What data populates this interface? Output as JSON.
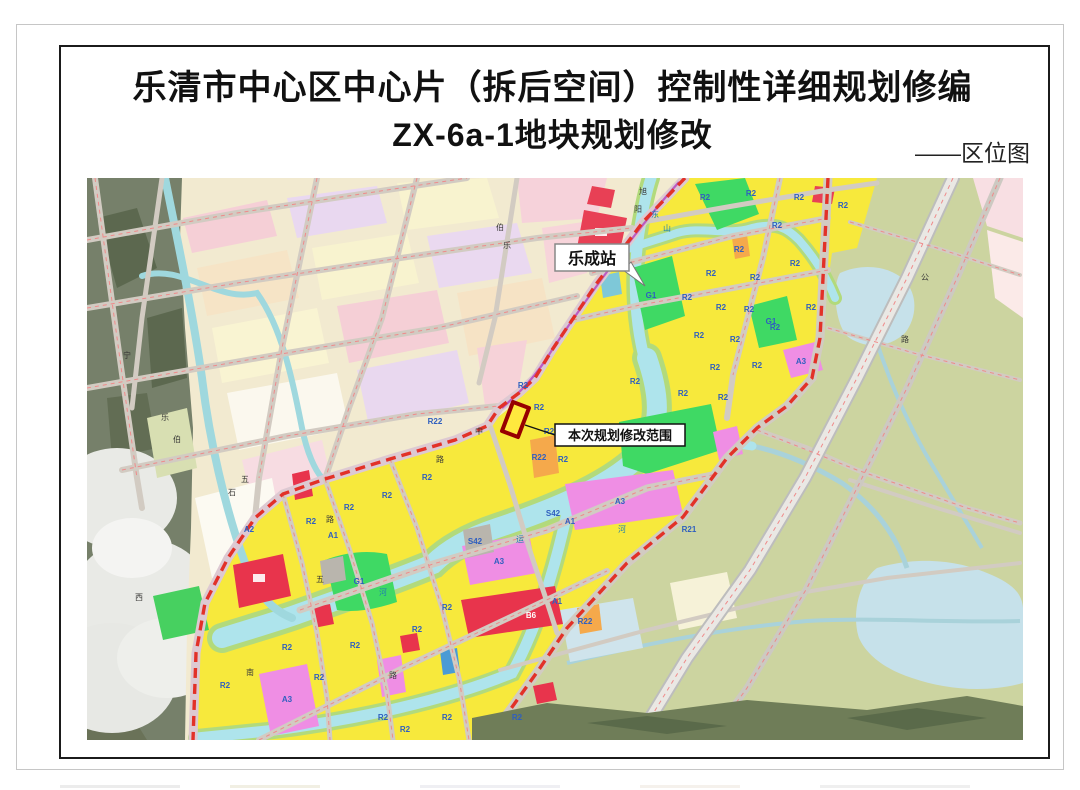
{
  "page": {
    "title_line1": "乐清市中心区中心片（拆后空间）控制性详细规划修编",
    "title_line2": "ZX-6a-1地块规划修改",
    "corner_label": "——区位图"
  },
  "map": {
    "callouts": {
      "station": "乐成站",
      "scope": "本次规划修改范围"
    },
    "colors": {
      "residential_yellow": "#f7e93c",
      "green_space": "#3fd964",
      "public_magenta": "#ef8ee4",
      "commercial_red": "#e8344c",
      "orange": "#f5a94b",
      "water_cyan": "#aee4ec",
      "rural_olive": "#ccd4a0",
      "boundary_red": "#e23128",
      "rail_purple": "#b84fc0",
      "old_plan_pink": "#f5cfd6"
    },
    "labels": [
      {
        "t": "R2",
        "x": 618,
        "y": 22,
        "c": "blue"
      },
      {
        "t": "R2",
        "x": 664,
        "y": 18,
        "c": "blue"
      },
      {
        "t": "R2",
        "x": 712,
        "y": 22,
        "c": "blue"
      },
      {
        "t": "R2",
        "x": 756,
        "y": 30,
        "c": "blue"
      },
      {
        "t": "R2",
        "x": 690,
        "y": 50,
        "c": "blue"
      },
      {
        "t": "R2",
        "x": 652,
        "y": 74,
        "c": "blue"
      },
      {
        "t": "R2",
        "x": 624,
        "y": 98,
        "c": "blue"
      },
      {
        "t": "R2",
        "x": 668,
        "y": 102,
        "c": "blue"
      },
      {
        "t": "R2",
        "x": 708,
        "y": 88,
        "c": "blue"
      },
      {
        "t": "R2",
        "x": 600,
        "y": 122,
        "c": "blue"
      },
      {
        "t": "R2",
        "x": 634,
        "y": 132,
        "c": "blue"
      },
      {
        "t": "R2",
        "x": 662,
        "y": 134,
        "c": "blue"
      },
      {
        "t": "R2",
        "x": 612,
        "y": 160,
        "c": "blue"
      },
      {
        "t": "R2",
        "x": 648,
        "y": 164,
        "c": "blue"
      },
      {
        "t": "R2",
        "x": 688,
        "y": 152,
        "c": "blue"
      },
      {
        "t": "R2",
        "x": 628,
        "y": 192,
        "c": "blue"
      },
      {
        "t": "R2",
        "x": 670,
        "y": 190,
        "c": "blue"
      },
      {
        "t": "R2",
        "x": 596,
        "y": 218,
        "c": "blue"
      },
      {
        "t": "R2",
        "x": 636,
        "y": 222,
        "c": "blue"
      },
      {
        "t": "R2",
        "x": 724,
        "y": 132,
        "c": "blue"
      },
      {
        "t": "R2",
        "x": 548,
        "y": 206,
        "c": "blue"
      },
      {
        "t": "R2",
        "x": 436,
        "y": 210,
        "c": "blue"
      },
      {
        "t": "R2",
        "x": 452,
        "y": 232,
        "c": "blue"
      },
      {
        "t": "R2",
        "x": 462,
        "y": 256,
        "c": "blue"
      },
      {
        "t": "R2",
        "x": 476,
        "y": 284,
        "c": "blue"
      },
      {
        "t": "R2",
        "x": 340,
        "y": 302,
        "c": "blue"
      },
      {
        "t": "R2",
        "x": 300,
        "y": 320,
        "c": "blue"
      },
      {
        "t": "R2",
        "x": 262,
        "y": 332,
        "c": "blue"
      },
      {
        "t": "R2",
        "x": 224,
        "y": 346,
        "c": "blue"
      },
      {
        "t": "R2",
        "x": 360,
        "y": 432,
        "c": "blue"
      },
      {
        "t": "R2",
        "x": 330,
        "y": 454,
        "c": "blue"
      },
      {
        "t": "R2",
        "x": 268,
        "y": 470,
        "c": "blue"
      },
      {
        "t": "R2",
        "x": 200,
        "y": 472,
        "c": "blue"
      },
      {
        "t": "R2",
        "x": 138,
        "y": 510,
        "c": "blue"
      },
      {
        "t": "R2",
        "x": 232,
        "y": 502,
        "c": "blue"
      },
      {
        "t": "R2",
        "x": 296,
        "y": 542,
        "c": "blue"
      },
      {
        "t": "R2",
        "x": 360,
        "y": 542,
        "c": "blue"
      },
      {
        "t": "R2",
        "x": 430,
        "y": 542,
        "c": "blue"
      },
      {
        "t": "R2",
        "x": 318,
        "y": 554,
        "c": "blue"
      },
      {
        "t": "A3",
        "x": 412,
        "y": 386,
        "c": "blue"
      },
      {
        "t": "A3",
        "x": 533,
        "y": 326,
        "c": "blue"
      },
      {
        "t": "A3",
        "x": 714,
        "y": 186,
        "c": "blue"
      },
      {
        "t": "A3",
        "x": 200,
        "y": 524,
        "c": "blue"
      },
      {
        "t": "A1",
        "x": 483,
        "y": 346,
        "c": "blue"
      },
      {
        "t": "A1",
        "x": 246,
        "y": 360,
        "c": "blue"
      },
      {
        "t": "A1",
        "x": 470,
        "y": 426,
        "c": "blue"
      },
      {
        "t": "A2",
        "x": 162,
        "y": 354,
        "c": "blue"
      },
      {
        "t": "S42",
        "x": 388,
        "y": 366,
        "c": "blue",
        "s": 7
      },
      {
        "t": "S42",
        "x": 466,
        "y": 338,
        "c": "blue",
        "s": 7
      },
      {
        "t": "R21",
        "x": 602,
        "y": 354,
        "c": "blue",
        "s": 7
      },
      {
        "t": "R22",
        "x": 452,
        "y": 282,
        "c": "blue",
        "s": 7
      },
      {
        "t": "R22",
        "x": 498,
        "y": 446,
        "c": "blue",
        "s": 7
      },
      {
        "t": "R22",
        "x": 348,
        "y": 246,
        "c": "blue",
        "s": 7
      },
      {
        "t": "G1",
        "x": 576,
        "y": 268,
        "c": "blue"
      },
      {
        "t": "G1",
        "x": 272,
        "y": 406,
        "c": "blue"
      },
      {
        "t": "G1",
        "x": 684,
        "y": 146,
        "c": "blue"
      },
      {
        "t": "G1",
        "x": 564,
        "y": 120,
        "c": "blue"
      },
      {
        "t": "B6",
        "x": 444,
        "y": 440,
        "c": "white"
      },
      {
        "t": "宁",
        "x": 40,
        "y": 180,
        "c": "road"
      },
      {
        "t": "乐",
        "x": 78,
        "y": 242,
        "c": "road"
      },
      {
        "t": "伯",
        "x": 90,
        "y": 264,
        "c": "road"
      },
      {
        "t": "西",
        "x": 52,
        "y": 422,
        "c": "road"
      },
      {
        "t": "五",
        "x": 158,
        "y": 304,
        "c": "road"
      },
      {
        "t": "五",
        "x": 233,
        "y": 404,
        "c": "road"
      },
      {
        "t": "路",
        "x": 243,
        "y": 344,
        "c": "road"
      },
      {
        "t": "路",
        "x": 353,
        "y": 284,
        "c": "road"
      },
      {
        "t": "中",
        "x": 392,
        "y": 256,
        "c": "road"
      },
      {
        "t": "南",
        "x": 163,
        "y": 497,
        "c": "road"
      },
      {
        "t": "石",
        "x": 145,
        "y": 317,
        "c": "road"
      },
      {
        "t": "路",
        "x": 306,
        "y": 500,
        "c": "road"
      },
      {
        "t": "伯",
        "x": 413,
        "y": 52,
        "c": "road"
      },
      {
        "t": "乐",
        "x": 420,
        "y": 70,
        "c": "road"
      },
      {
        "t": "旭",
        "x": 556,
        "y": 16,
        "c": "road"
      },
      {
        "t": "阳",
        "x": 551,
        "y": 34,
        "c": "road"
      },
      {
        "t": "公",
        "x": 838,
        "y": 102,
        "c": "road"
      },
      {
        "t": "路",
        "x": 818,
        "y": 164,
        "c": "road"
      },
      {
        "t": "运",
        "x": 433,
        "y": 364,
        "c": "river"
      },
      {
        "t": "河",
        "x": 535,
        "y": 354,
        "c": "river"
      },
      {
        "t": "东",
        "x": 568,
        "y": 39,
        "c": "river"
      },
      {
        "t": "山",
        "x": 580,
        "y": 53,
        "c": "river"
      },
      {
        "t": "河",
        "x": 296,
        "y": 417,
        "c": "river"
      }
    ]
  }
}
